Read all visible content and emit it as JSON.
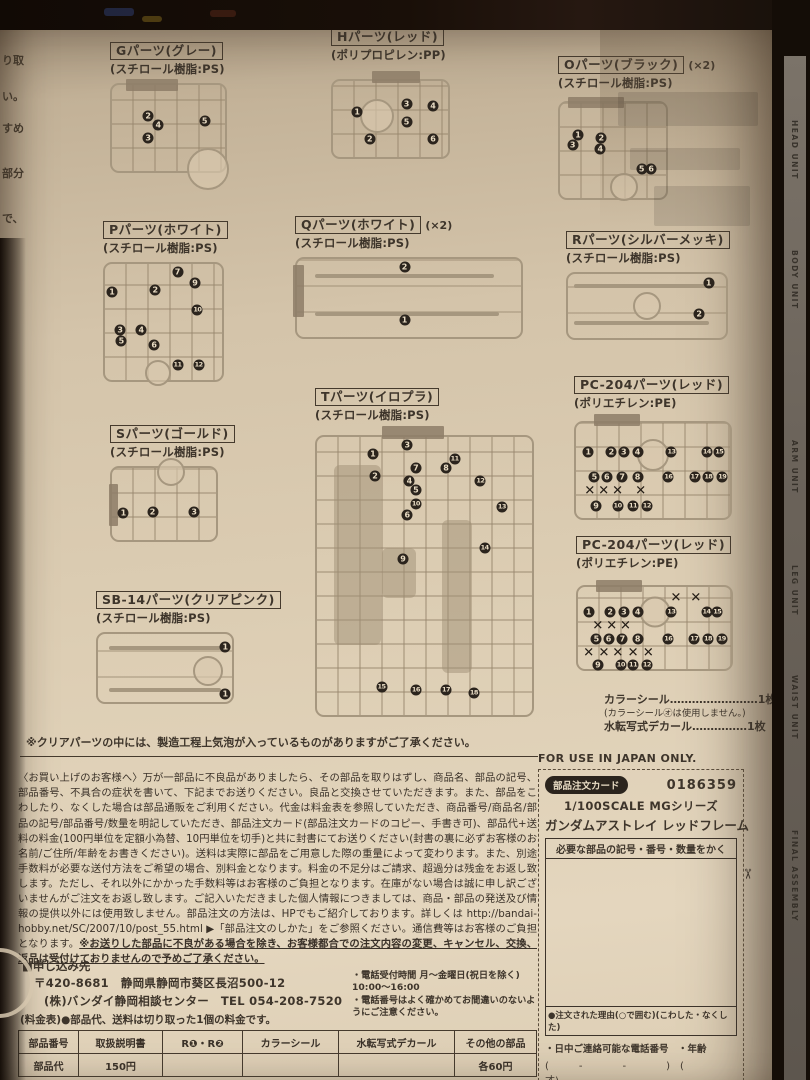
{
  "colors": {
    "paper": "#ddcdb3",
    "ink": "#3e352b",
    "sprue_line": "#a6977f",
    "badge_bg": "#2b241d"
  },
  "edge": {
    "left_snippets": [
      {
        "t": "り取",
        "top": 18
      },
      {
        "t": "い。",
        "top": 54
      },
      {
        "t": "すめ",
        "top": 86
      },
      {
        "t": "部分",
        "top": 131
      },
      {
        "t": "で、",
        "top": 176
      }
    ],
    "right_labels": [
      {
        "t": "HEAD UNIT",
        "top": 64
      },
      {
        "t": "BODY UNIT",
        "top": 194
      },
      {
        "t": "ARM UNIT",
        "top": 384
      },
      {
        "t": "LEG UNIT",
        "top": 509
      },
      {
        "t": "WAIST UNIT",
        "top": 619
      },
      {
        "t": "FINAL ASSEMBLY",
        "top": 774
      }
    ]
  },
  "sprues": [
    {
      "label": "Gパーツ(グレー)",
      "mult": "",
      "material": "(スチロール樹脂:PS)",
      "badges": [
        {
          "n": "2",
          "x": 32,
          "y": 36
        },
        {
          "n": "4",
          "x": 41,
          "y": 47
        },
        {
          "n": "3",
          "x": 32,
          "y": 62
        },
        {
          "n": "5",
          "x": 82,
          "y": 42
        }
      ],
      "circle": {
        "x": 85,
        "y": 98,
        "d": 38
      },
      "tabs": [
        {
          "x": 12,
          "y": -7,
          "w": 52,
          "h": 12
        }
      ]
    },
    {
      "label": "Hパーツ(レッド)",
      "mult": "",
      "material": "(ポリプロピレン:PP)",
      "badges": [
        {
          "n": "1",
          "x": 21,
          "y": 41
        },
        {
          "n": "2",
          "x": 32,
          "y": 76
        },
        {
          "n": "3",
          "x": 64,
          "y": 30
        },
        {
          "n": "4",
          "x": 87,
          "y": 33
        },
        {
          "n": "5",
          "x": 64,
          "y": 54
        },
        {
          "n": "6",
          "x": 87,
          "y": 76
        }
      ],
      "circle": {
        "x": 38,
        "y": 46,
        "d": 30
      },
      "tabs": [
        {
          "x": 34,
          "y": -13,
          "w": 48,
          "h": 12
        }
      ]
    },
    {
      "label": "Oパーツ(ブラック)",
      "mult": "(×2)",
      "material": "(スチロール樹脂:PS)",
      "badges": [
        {
          "n": "1",
          "x": 17,
          "y": 34
        },
        {
          "n": "2",
          "x": 39,
          "y": 37
        },
        {
          "n": "3",
          "x": 12,
          "y": 44
        },
        {
          "n": "4",
          "x": 38,
          "y": 48
        },
        {
          "n": "5",
          "x": 77,
          "y": 69
        },
        {
          "n": "6",
          "x": 86,
          "y": 69
        }
      ],
      "circle": {
        "x": 60,
        "y": 88,
        "d": 24
      },
      "tabs": [
        {
          "x": 8,
          "y": -6,
          "w": 56,
          "h": 11
        }
      ]
    },
    {
      "label": "Pパーツ(ホワイト)",
      "mult": "",
      "material": "(スチロール樹脂:PS)",
      "badges": [
        {
          "n": "1",
          "x": 6,
          "y": 24
        },
        {
          "n": "2",
          "x": 43,
          "y": 22
        },
        {
          "n": "7",
          "x": 62,
          "y": 7
        },
        {
          "n": "9",
          "x": 77,
          "y": 16
        },
        {
          "n": "10",
          "x": 79,
          "y": 40
        },
        {
          "n": "3",
          "x": 13,
          "y": 57
        },
        {
          "n": "4",
          "x": 31,
          "y": 57
        },
        {
          "n": "5",
          "x": 14,
          "y": 66
        },
        {
          "n": "6",
          "x": 42,
          "y": 70
        },
        {
          "n": "11",
          "x": 62,
          "y": 87
        },
        {
          "n": "12",
          "x": 80,
          "y": 87
        }
      ],
      "circle": {
        "x": 45,
        "y": 94,
        "d": 22
      },
      "tabs": []
    },
    {
      "label": "Qパーツ(ホワイト)",
      "mult": "(×2)",
      "material": "(スチロール樹脂:PS)",
      "badges": [
        {
          "n": "2",
          "x": 48,
          "y": 10
        },
        {
          "n": "1",
          "x": 48,
          "y": 78
        }
      ],
      "circle": null,
      "tabs": [
        {
          "x": -2,
          "y": 8,
          "w": 11,
          "h": 52
        }
      ],
      "blades": [
        {
          "x": 8,
          "y": 22,
          "w": 80
        },
        {
          "x": 8,
          "y": 70,
          "w": 82
        }
      ]
    },
    {
      "label": "Rパーツ(シルバーメッキ)",
      "mult": "",
      "material": "(スチロール樹脂:PS)",
      "badges": [
        {
          "n": "1",
          "x": 89,
          "y": 14
        },
        {
          "n": "2",
          "x": 83,
          "y": 63
        }
      ],
      "circle": {
        "x": 50,
        "y": 50,
        "d": 24
      },
      "tabs": [],
      "blades": [
        {
          "x": 4,
          "y": 18,
          "w": 85
        },
        {
          "x": 4,
          "y": 76,
          "w": 85
        }
      ]
    },
    {
      "label": "Sパーツ(ゴールド)",
      "mult": "",
      "material": "(スチロール樹脂:PS)",
      "badges": [
        {
          "n": "1",
          "x": 11,
          "y": 62
        },
        {
          "n": "2",
          "x": 39,
          "y": 61
        },
        {
          "n": "3",
          "x": 79,
          "y": 61
        }
      ],
      "circle": {
        "x": 57,
        "y": 6,
        "d": 24
      },
      "tabs": [
        {
          "x": -3,
          "y": 22,
          "w": 9,
          "h": 42
        }
      ]
    },
    {
      "label": "Tパーツ(イロプラ)",
      "mult": "",
      "material": "(スチロール樹脂:PS)",
      "badges": [
        {
          "n": "1",
          "x": 26,
          "y": 6
        },
        {
          "n": "2",
          "x": 27,
          "y": 14
        },
        {
          "n": "3",
          "x": 42,
          "y": 3
        },
        {
          "n": "7",
          "x": 46,
          "y": 11
        },
        {
          "n": "8",
          "x": 60,
          "y": 11
        },
        {
          "n": "11",
          "x": 64,
          "y": 8
        },
        {
          "n": "4",
          "x": 43,
          "y": 16
        },
        {
          "n": "5",
          "x": 46,
          "y": 19
        },
        {
          "n": "12",
          "x": 76,
          "y": 16
        },
        {
          "n": "10",
          "x": 46,
          "y": 24
        },
        {
          "n": "6",
          "x": 42,
          "y": 28
        },
        {
          "n": "13",
          "x": 86,
          "y": 25
        },
        {
          "n": "14",
          "x": 78,
          "y": 40
        },
        {
          "n": "9",
          "x": 40,
          "y": 44
        },
        {
          "n": "15",
          "x": 30,
          "y": 90
        },
        {
          "n": "16",
          "x": 46,
          "y": 91
        },
        {
          "n": "17",
          "x": 60,
          "y": 91
        },
        {
          "n": "18",
          "x": 73,
          "y": 92
        }
      ],
      "circle": null,
      "tabs": [
        {
          "x": 30,
          "y": -4,
          "w": 62,
          "h": 13
        }
      ],
      "blobs": [
        {
          "x": 8,
          "y": 10,
          "w": 22,
          "h": 65
        },
        {
          "x": 58,
          "y": 30,
          "w": 14,
          "h": 55
        },
        {
          "x": 30,
          "y": 40,
          "w": 16,
          "h": 18
        }
      ]
    },
    {
      "label": "SB-14パーツ(クリアピンク)",
      "mult": "",
      "material": "(スチロール樹脂:PS)",
      "badges": [
        {
          "n": "1",
          "x": 95,
          "y": 19
        },
        {
          "n": "1",
          "x": 95,
          "y": 88
        }
      ],
      "circle": {
        "x": 82,
        "y": 55,
        "d": 26
      },
      "tabs": [],
      "blades": [
        {
          "x": 8,
          "y": 20,
          "w": 84
        },
        {
          "x": 8,
          "y": 82,
          "w": 84
        }
      ]
    },
    {
      "label": "PC-204パーツ(レッド)",
      "mult": "",
      "material": "(ポリエチレン:PE)",
      "badges": [
        {
          "n": "1",
          "x": 8,
          "y": 30
        },
        {
          "n": "2",
          "x": 23,
          "y": 30
        },
        {
          "n": "3",
          "x": 31,
          "y": 30
        },
        {
          "n": "4",
          "x": 40,
          "y": 30
        },
        {
          "n": "13",
          "x": 62,
          "y": 30
        },
        {
          "n": "14",
          "x": 85,
          "y": 30
        },
        {
          "n": "15",
          "x": 93,
          "y": 30
        },
        {
          "n": "5",
          "x": 12,
          "y": 57
        },
        {
          "n": "6",
          "x": 20,
          "y": 57
        },
        {
          "n": "7",
          "x": 30,
          "y": 57
        },
        {
          "n": "8",
          "x": 40,
          "y": 57
        },
        {
          "n": "16",
          "x": 60,
          "y": 57
        },
        {
          "n": "17",
          "x": 77,
          "y": 57
        },
        {
          "n": "18",
          "x": 86,
          "y": 57
        },
        {
          "n": "19",
          "x": 95,
          "y": 57
        },
        {
          "n": "9",
          "x": 13,
          "y": 87
        },
        {
          "n": "10",
          "x": 27,
          "y": 87
        },
        {
          "n": "11",
          "x": 37,
          "y": 87
        },
        {
          "n": "12",
          "x": 46,
          "y": 87
        }
      ],
      "xmarks": [
        {
          "x": 9,
          "y": 72
        },
        {
          "x": 18,
          "y": 72
        },
        {
          "x": 27,
          "y": 72
        },
        {
          "x": 42,
          "y": 72
        }
      ],
      "circle": {
        "x": 50,
        "y": 34,
        "d": 28
      },
      "tabs": [
        {
          "x": 12,
          "y": -9,
          "w": 46,
          "h": 12
        }
      ]
    },
    {
      "label": "PC-204パーツ(レッド)",
      "mult": "",
      "material": "(ポリエチレン:PE)",
      "badges": [
        {
          "n": "1",
          "x": 7,
          "y": 31
        },
        {
          "n": "2",
          "x": 21,
          "y": 31
        },
        {
          "n": "3",
          "x": 30,
          "y": 31
        },
        {
          "n": "4",
          "x": 39,
          "y": 31
        },
        {
          "n": "13",
          "x": 61,
          "y": 31
        },
        {
          "n": "14",
          "x": 84,
          "y": 31
        },
        {
          "n": "15",
          "x": 91,
          "y": 31
        },
        {
          "n": "5",
          "x": 12,
          "y": 64
        },
        {
          "n": "6",
          "x": 20,
          "y": 64
        },
        {
          "n": "7",
          "x": 29,
          "y": 64
        },
        {
          "n": "8",
          "x": 39,
          "y": 64
        },
        {
          "n": "16",
          "x": 59,
          "y": 64
        },
        {
          "n": "17",
          "x": 76,
          "y": 64
        },
        {
          "n": "18",
          "x": 85,
          "y": 64
        },
        {
          "n": "19",
          "x": 94,
          "y": 64
        },
        {
          "n": "9",
          "x": 13,
          "y": 95
        },
        {
          "n": "10",
          "x": 28,
          "y": 95
        },
        {
          "n": "11",
          "x": 36,
          "y": 95
        },
        {
          "n": "12",
          "x": 45,
          "y": 95
        }
      ],
      "xmarks": [
        {
          "x": 64,
          "y": 14
        },
        {
          "x": 77,
          "y": 14
        },
        {
          "x": 13,
          "y": 48
        },
        {
          "x": 22,
          "y": 48
        },
        {
          "x": 31,
          "y": 48
        },
        {
          "x": 7,
          "y": 80
        },
        {
          "x": 17,
          "y": 80
        },
        {
          "x": 26,
          "y": 80
        },
        {
          "x": 36,
          "y": 80
        },
        {
          "x": 46,
          "y": 80
        }
      ],
      "circle": {
        "x": 50,
        "y": 30,
        "d": 27
      },
      "tabs": [
        {
          "x": 12,
          "y": -9,
          "w": 46,
          "h": 12
        }
      ]
    }
  ],
  "accessories": {
    "line1": "カラーシール……………………1枚",
    "line2": "(カラーシール㋔は使用しません。)",
    "line3": "水転写式デカール……………1枚"
  },
  "clear_note": "※クリアパーツの中には、製造工程上気泡が入っているものがありますがご了承ください。",
  "order_info": {
    "paragraph": "〈お買い上げのお客様へ〉万が一部品に不良品がありましたら、その部品を取りはずし、商品名、部品の記号、部品番号、不具合の症状を書いて、下記までお送りください。良品と交換させていただきます。また、部品をこわしたり、なくした場合は部品通販をご利用ください。代金は料金表を参照していただき、商品番号/商品名/部品の記号/部品番号/数量を明記していただき、部品注文カード(部品注文カードのコピー、手書き可)、部品代+送料の料金(100円単位を定額小為替、10円単位を切手)と共に封書にてお送りください(封書の裏に必ずお客様のお名前/ご住所/年齢をお書きください)。送料は実際に部品をご用意した際の重量によって変わります。また、別途手数料が必要な送付方法をご希望の場合、別料金となります。料金の不足分はご請求、超過分は残金をお返し致します。ただし、それ以外にかかった手数料等はお客様のご負担となります。在庫がない場合は誠に申し訳ございませんがご注文をお返し致します。ご記入いただきました個人情報につきましては、商品・部品の発送及び情報の提供以外には使用致しません。部品注文の方法は、HPでもご紹介しております。詳しくは http://bandai-hobby.net/SC/2007/10/post_55.html ▶「部品注文のしかた」をご参照ください。通信費等はお客様のご負担となります。",
    "warning": "※お送りした部品に不良がある場合を除き、お客様都合での注文内容の変更、キャンセル、交換、返品は受付けておりませんので予めご了承ください。",
    "address_heading": "■申し込み先",
    "postal": "〒420-8681",
    "address": "静岡県静岡市葵区長沼500-12",
    "company": "(株)バンダイ静岡相談センター",
    "tel": "TEL 054-208-7520",
    "phone_hours": "・電話受付時間 月〜金曜日(祝日を除く) 10:00〜16:00",
    "phone_note": "・電話番号はよく確かめてお間違いのないようにご注意ください。",
    "price_table_label": "(料金表)",
    "price_note": "●部品代、送料は切り取った1個の料金です。"
  },
  "price_table": {
    "headers": [
      "部品番号",
      "取扱説明書",
      "R❶・R❷",
      "カラーシール",
      "水転写式デカール",
      "その他の部品"
    ],
    "row": [
      "部品代",
      "150円",
      "",
      "",
      "",
      "各60円"
    ]
  },
  "order_card": {
    "for_japan": "FOR USE IN JAPAN ONLY.",
    "pill": "部品注文カード",
    "serial": "0186359",
    "series": "1/100SCALE MGシリーズ",
    "product": "ガンダムアストレイ レッドフレーム",
    "field_head": "必要な部品の記号・番号・数量をかく",
    "reason": "●注文された理由(○で囲む)(こわした・なくした)",
    "phone_age": "・日中ご連絡可能な電話番号　・年齢",
    "blanks": "(　　　-　　　　-　　　　)　(　　　　才)",
    "date": "'14.01",
    "scissors": "✂"
  }
}
